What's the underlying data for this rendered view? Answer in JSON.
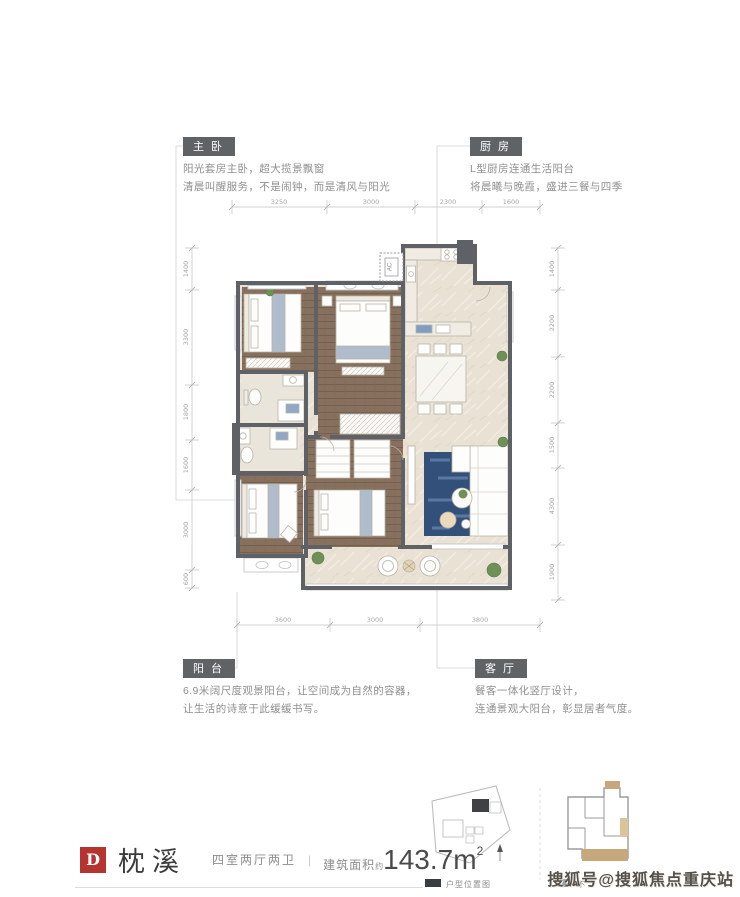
{
  "annotations": {
    "master": {
      "tag": "主卧",
      "line1": "阳光套房主卧，超大揽景飘窗",
      "line2": "清晨叫醒服务，不是闹钟，而是清风与阳光"
    },
    "kitchen": {
      "tag": "厨房",
      "line1": "L型厨房连通生活阳台",
      "line2": "将晨曦与晚霞，盛进三餐与四季"
    },
    "balcony": {
      "tag": "阳台",
      "line1": "6.9米阔尺度观景阳台，让空间成为自然的容器，",
      "line2": "让生活的诗意于此缓缓书写。"
    },
    "living": {
      "tag": "客厅",
      "line1": "餐客一体化竖厅设计，",
      "line2": "连通景观大阳台，彰显居者气度。"
    }
  },
  "dimensions": {
    "top": [
      "3250",
      "3000",
      "2300",
      "1600"
    ],
    "bottom": [
      "3600",
      "3000",
      "3800"
    ],
    "left": [
      "1400",
      "3300",
      "1800",
      "1600",
      "3000",
      "600"
    ],
    "right": [
      "1400",
      "2200",
      "2200",
      "1500",
      "4300",
      "1900"
    ]
  },
  "plan": {
    "ac_label": "AC"
  },
  "title": {
    "unit_letter": "D",
    "unit_name": "枕溪",
    "layout": "四室两厅两卫",
    "separator": "|",
    "area_prefix": "建筑面积",
    "area_approx": "约",
    "area_value": "143.7m",
    "area_sup": "2"
  },
  "legend": {
    "location_caption": "户型位置图",
    "note_caption": "不"
  },
  "watermark": "搜狐号@搜狐焦点重庆站",
  "colors": {
    "accent_red": "#b5342f",
    "wall": "#5e6165",
    "wood_floor": "#87705d",
    "marble_floor": "#e8e1d4",
    "rug_blue": "#33507a",
    "balcony_tan": "#c7a87c"
  }
}
